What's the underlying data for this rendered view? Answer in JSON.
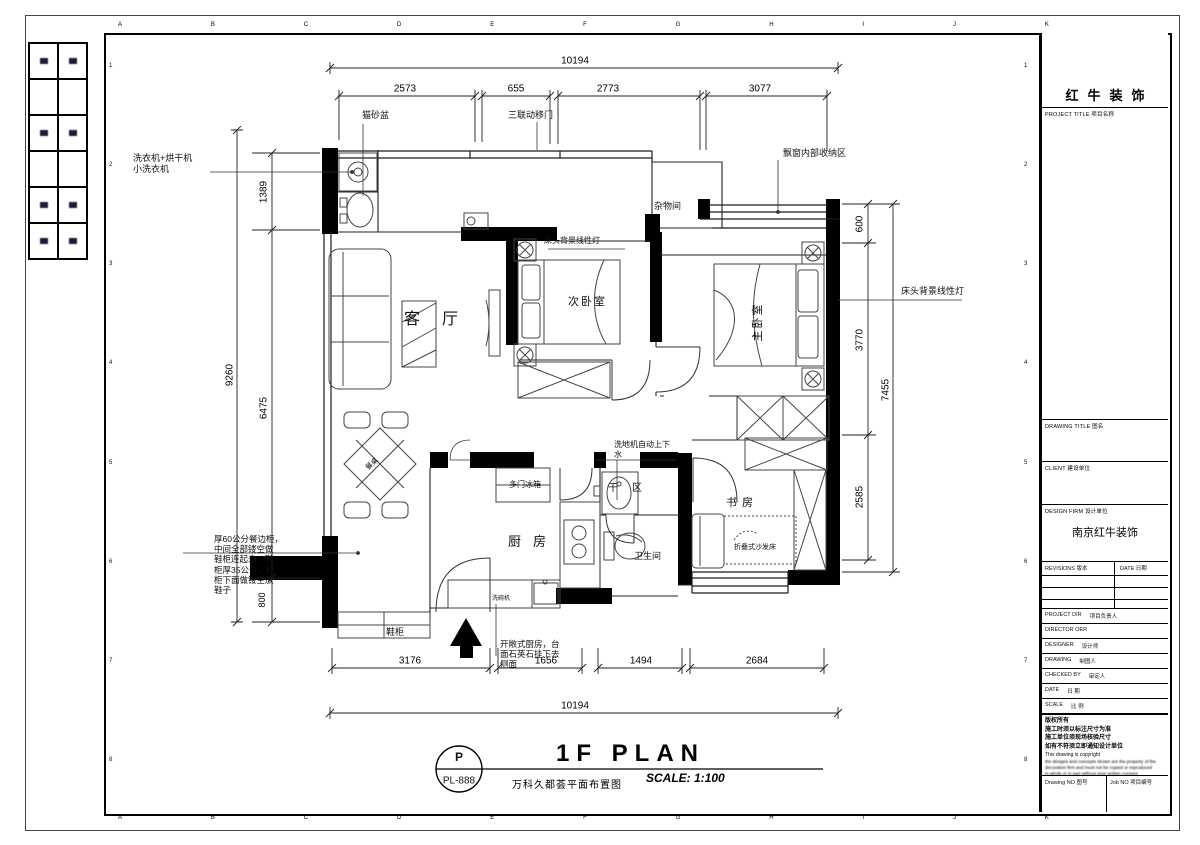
{
  "frame": {
    "grid_letters_top": [
      "A",
      "B",
      "C",
      "D",
      "E",
      "F",
      "G",
      "H",
      "I",
      "J",
      "K"
    ],
    "grid_letters_bottom": [
      "A",
      "B",
      "C",
      "D",
      "E",
      "F",
      "G",
      "H",
      "I",
      "J",
      "K"
    ],
    "grid_numbers_left": [
      "1",
      "2",
      "3",
      "4",
      "5",
      "6",
      "7",
      "8"
    ],
    "grid_numbers_right": [
      "1",
      "2",
      "3",
      "4",
      "5",
      "6",
      "7",
      "8"
    ]
  },
  "title_block": {
    "company_name": "红牛装饰",
    "project_title_label": "PROJECT TITLE 项目名称",
    "drawing_title_label": "DRAWING TITLE 图名",
    "client_label": "CLIENT 建设单位",
    "design_firm_label": "DESIGN FIRM 设计单位",
    "design_firm_value": "南京红牛装饰",
    "revisions_label": "REVISIONS 版本",
    "revisions_date_label": "DATE 日期",
    "rows": [
      {
        "en": "PROJECT DIR",
        "cn": "项目负责人"
      },
      {
        "en": "DIRECTOR OER",
        "cn": ""
      },
      {
        "en": "DESIGNER",
        "cn": "设计师"
      },
      {
        "en": "DRAWING",
        "cn": "制图人"
      },
      {
        "en": "CHECKED BY",
        "cn": "审定人"
      },
      {
        "en": "DATE",
        "cn": "日 期"
      },
      {
        "en": "SCALE",
        "cn": "比 例"
      }
    ],
    "notes": [
      "版权所有",
      "施工时须以标注尺寸为准",
      "施工单位须现场核验尺寸",
      "如有不符须立即通知设计单位",
      "This drawing is copyright",
      "the designs and concepts shown are the property of the",
      "decoration firm and must not be copied or reproduced",
      "in whole or in part without prior written consent"
    ],
    "drawing_no_label": "Drawing NO 图号",
    "job_no_label": "Job NO 项目编号"
  },
  "plan": {
    "rooms": {
      "living_room": "客厅",
      "second_bedroom": "次卧室",
      "master_bedroom": "主卧室",
      "storage_room": "杂物间",
      "kitchen": "厨房",
      "bathroom": "卫生间",
      "study": "书房",
      "dry_area": "干区"
    },
    "annotations": {
      "cat_litter": "猫砂盆",
      "washer_note": "洗衣机+烘干机\n小洗衣机",
      "triple_sliding_door": "三联动移门",
      "bay_window_storage": "飘窗内部收纳区",
      "bedhead_light_second": "床头背景线性灯",
      "bedhead_light_master": "床头背景线性灯",
      "floor_washer": "洗地机自动上下\n水",
      "fridge": "多门冰箱",
      "dishwasher": "洗碗机",
      "folding_sofa_bed": "折叠式沙发床",
      "shoe_cabinet": "鞋柜",
      "dining_table": "餐桌",
      "sideboard_note": "厚60公分餐边柜，\n中间全部镂空做\n鞋柜连起来，鞋\n柜厚35公分，鞋\n柜下面做镂空放\n鞋子",
      "open_kitchen_note": "开敞式厨房，台\n面石英石挂下去\n侧面"
    },
    "dimensions": {
      "top_total": "10194",
      "top": [
        "2573",
        "655",
        "2773",
        "3077"
      ],
      "bottom": [
        "3176",
        "1656",
        "1494",
        "2684"
      ],
      "bottom_total": "10194",
      "left_outer": "9260",
      "left_inner": [
        "1389",
        "6475",
        "800"
      ],
      "right_outer": "7455",
      "right_inner": [
        "600",
        "3770",
        "2585"
      ]
    }
  },
  "footer": {
    "tag_top": "P",
    "tag_bottom": "PL-888",
    "title": "1F PLAN",
    "subtitle": "万科久都荟平面布置图",
    "scale": "SCALE: 1:100"
  }
}
